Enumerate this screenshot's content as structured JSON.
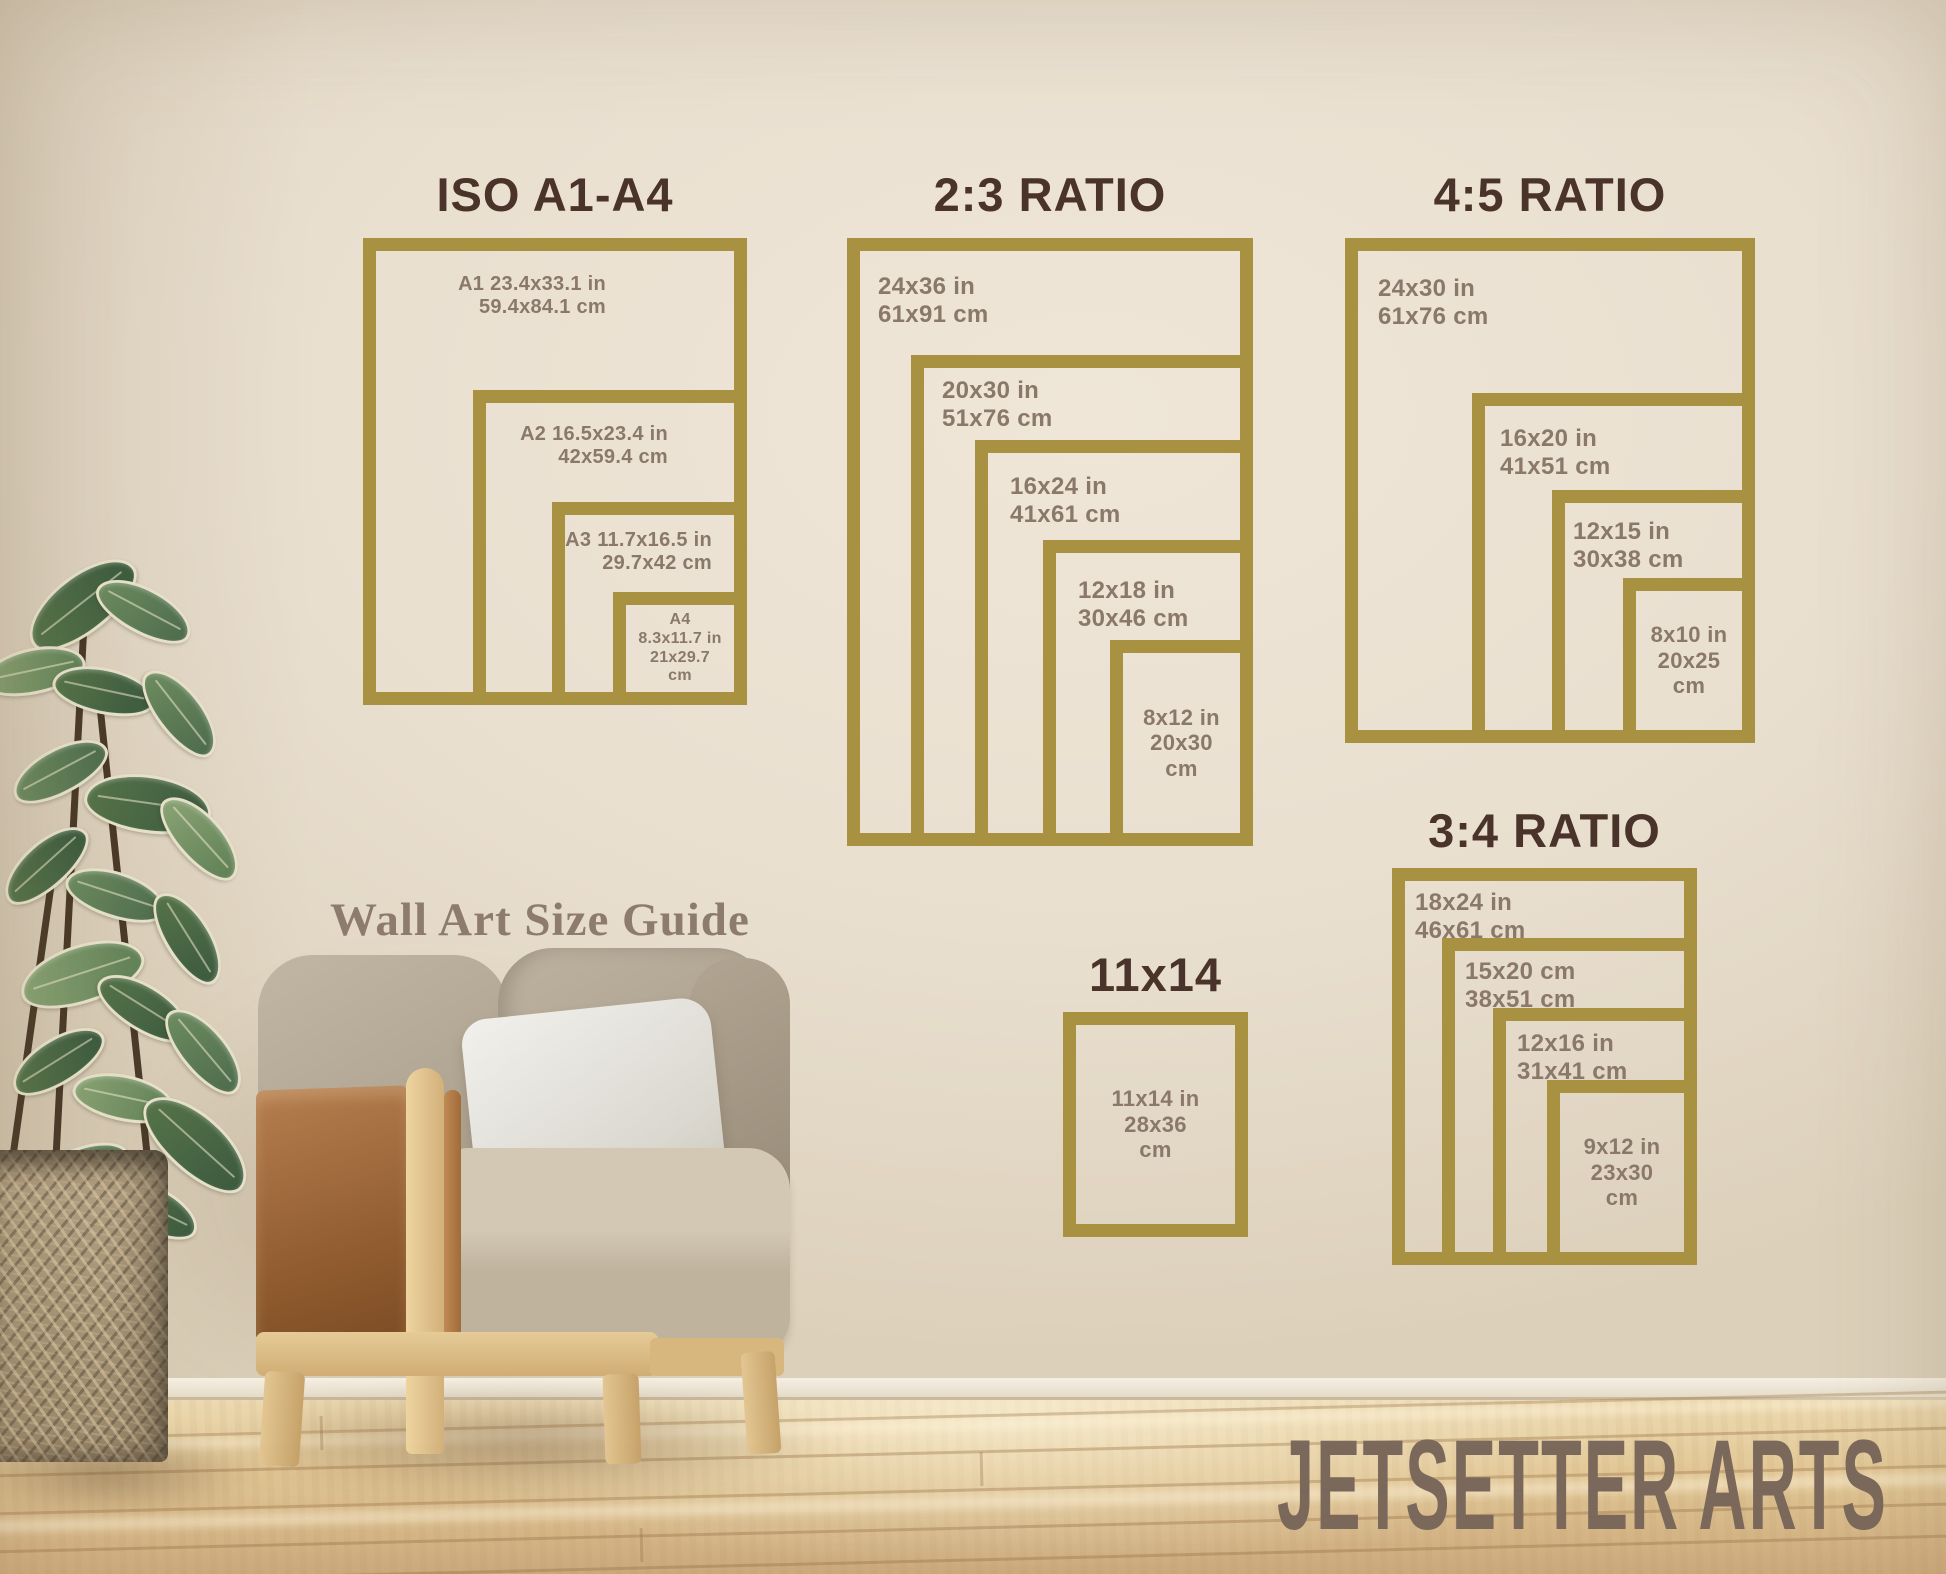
{
  "headline": {
    "text": "Wall Art Size Guide"
  },
  "brand": {
    "text": "JETSETTER ARTS"
  },
  "colors": {
    "frame_gold": "#a89242",
    "heading_brown": "#4a332a",
    "label_taupe": "#8a796b",
    "headline_taupe": "#8d7c6d",
    "brand_taupe": "#7b695c",
    "wall": "#e9dfcf"
  },
  "groups": [
    {
      "id": "iso-a1-a4",
      "title": "ISO A1-A4",
      "frames": [
        {
          "name": "A1",
          "lines": [
            "A1 23.4x33.1 in",
            "59.4x84.1 cm"
          ]
        },
        {
          "name": "A2",
          "lines": [
            "A2 16.5x23.4 in",
            "42x59.4 cm"
          ]
        },
        {
          "name": "A3",
          "lines": [
            "A3 11.7x16.5 in",
            "29.7x42 cm"
          ]
        },
        {
          "name": "A4",
          "lines": [
            "A4",
            "8.3x11.7 in",
            "21x29.7",
            "cm"
          ]
        }
      ]
    },
    {
      "id": "ratio-2-3",
      "title": "2:3 RATIO",
      "frames": [
        {
          "name": "24x36",
          "lines": [
            "24x36 in",
            "61x91 cm"
          ]
        },
        {
          "name": "20x30",
          "lines": [
            "20x30 in",
            "51x76 cm"
          ]
        },
        {
          "name": "16x24",
          "lines": [
            "16x24 in",
            "41x61 cm"
          ]
        },
        {
          "name": "12x18",
          "lines": [
            "12x18 in",
            "30x46 cm"
          ]
        },
        {
          "name": "8x12",
          "lines": [
            "8x12 in",
            "20x30",
            "cm"
          ]
        }
      ]
    },
    {
      "id": "ratio-4-5",
      "title": "4:5 RATIO",
      "frames": [
        {
          "name": "24x30",
          "lines": [
            "24x30 in",
            "61x76 cm"
          ]
        },
        {
          "name": "16x20",
          "lines": [
            "16x20 in",
            "41x51 cm"
          ]
        },
        {
          "name": "12x15",
          "lines": [
            "12x15 in",
            "30x38 cm"
          ]
        },
        {
          "name": "8x10",
          "lines": [
            "8x10 in",
            "20x25",
            "cm"
          ]
        }
      ]
    },
    {
      "id": "ratio-3-4",
      "title": "3:4 RATIO",
      "frames": [
        {
          "name": "18x24",
          "lines": [
            "18x24 in",
            "46x61 cm"
          ]
        },
        {
          "name": "15x20",
          "lines": [
            "15x20 cm",
            "38x51 cm"
          ]
        },
        {
          "name": "12x16",
          "lines": [
            "12x16 in",
            "31x41 cm"
          ]
        },
        {
          "name": "9x12",
          "lines": [
            "9x12 in",
            "23x30",
            "cm"
          ]
        }
      ]
    },
    {
      "id": "size-11x14",
      "title": "11x14",
      "frames": [
        {
          "name": "11x14",
          "lines": [
            "11x14 in",
            "28x36",
            "cm"
          ]
        }
      ]
    }
  ]
}
